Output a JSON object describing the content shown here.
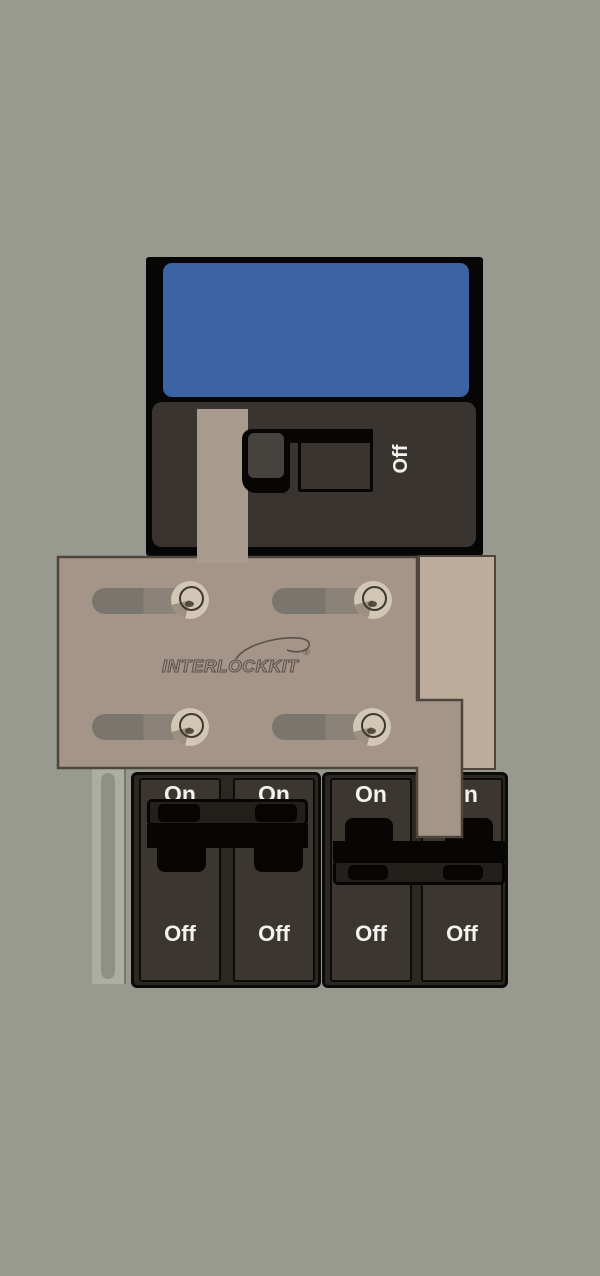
{
  "main_breaker": {
    "switch_label": "Off",
    "label_panel_color": "#3b63a3",
    "body_color": "#393430"
  },
  "interlock_kit": {
    "brand": "INTERLOCKKIT",
    "registered_mark": "®",
    "plate_color": "#a59488",
    "backing_color": "#bdac9b"
  },
  "branch_breakers": [
    {
      "on_label": "On",
      "off_label": "Off"
    },
    {
      "on_label": "On",
      "off_label": "Off"
    },
    {
      "on_label": "On",
      "off_label": "Off"
    },
    {
      "on_label": "On",
      "off_label": "Off"
    }
  ]
}
